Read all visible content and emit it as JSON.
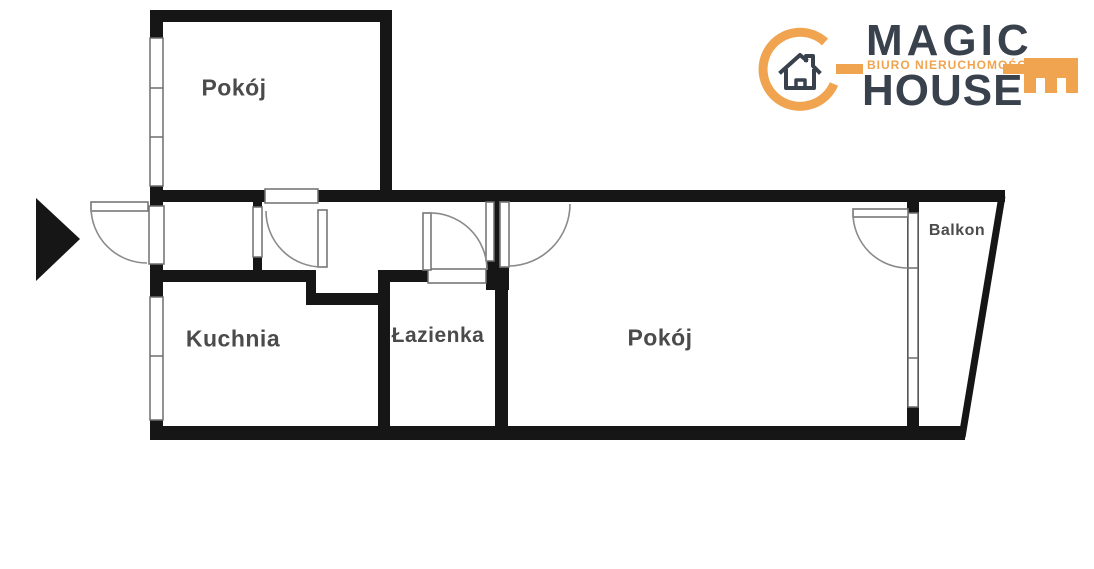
{
  "page": {
    "type": "apartment floor plan scan",
    "background": "#ffffff"
  },
  "logo": {
    "title_top": "MAGIC",
    "title_bottom": "HOUSE",
    "tagline": "BIURO NIERUCHOMOŚCI",
    "accent_color": "#F0A44F",
    "text_color": "#39424C",
    "icon": "key-ring-with-house-icon"
  },
  "floorplan": {
    "wall_color": "#161616",
    "label_color": "#4B4B4B",
    "rooms": [
      {
        "id": "room-top-left",
        "label": "Pokój"
      },
      {
        "id": "kitchen",
        "label": "Kuchnia"
      },
      {
        "id": "bathroom",
        "label": "Łazienka"
      },
      {
        "id": "room-main",
        "label": "Pokój"
      },
      {
        "id": "balcony",
        "label": "Balkon"
      }
    ],
    "entrance": {
      "marker": "arrow-right-icon",
      "side": "left"
    }
  }
}
